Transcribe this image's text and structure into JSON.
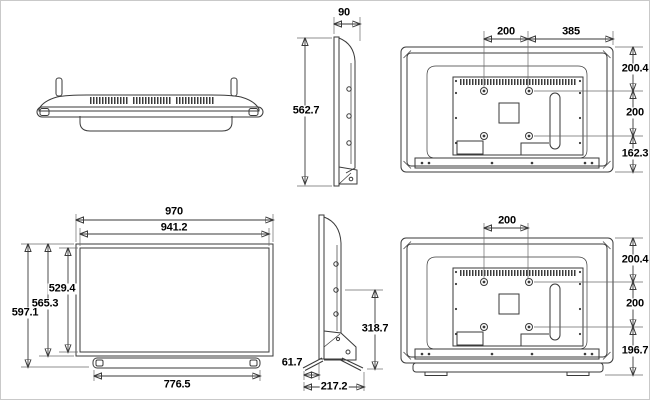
{
  "diagram_title": "TV dimension drawing (six orthographic views)",
  "colors": {
    "line": "#3a3a3a",
    "text": "#000000",
    "background": "#ffffff",
    "frame_border": "#c9c9c9"
  },
  "views": {
    "side": {
      "depth": "90",
      "height": "562.7"
    },
    "rear": {
      "vesa_horizontal": "200",
      "vesa_to_right_edge": "385",
      "top_to_vesa": "200.4",
      "vesa_vertical": "200",
      "vesa_to_bottom": "162.3"
    },
    "front": {
      "overall_width": "970",
      "screen_width": "941.2",
      "screen_height": "529.4",
      "body_height": "565.3",
      "overall_height": "597.1",
      "stand_width": "776.5"
    },
    "side_with_stand": {
      "front_overhang": "61.7",
      "stand_depth": "217.2",
      "mount_height": "318.7"
    },
    "rear_with_stand": {
      "vesa_horizontal": "200",
      "top_to_vesa": "200.4",
      "vesa_vertical": "200",
      "vesa_to_stand_bottom": "196.7"
    }
  }
}
